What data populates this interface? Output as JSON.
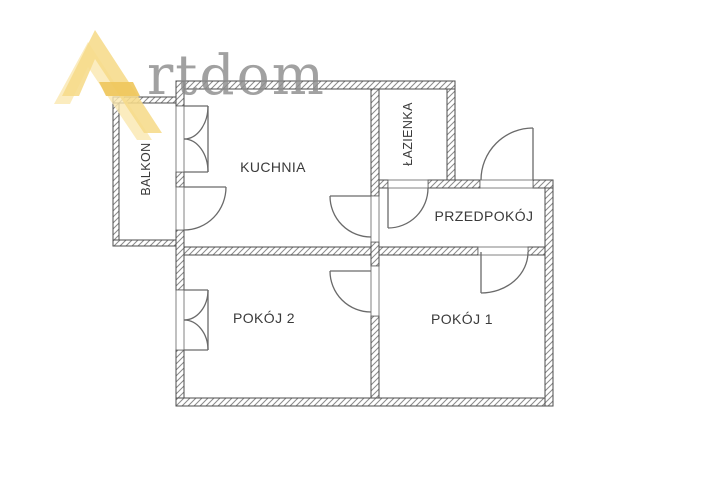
{
  "watermark": {
    "brand": "Artdom",
    "text": "rtdom",
    "logo_icon": "artdom-a-triangle-logo",
    "text_color": "#8d8d8d",
    "logo_color_light": "#fae7af",
    "logo_color_main": "#f6db8a",
    "logo_color_dark": "#eec75c"
  },
  "floor_plan": {
    "rooms": {
      "balkon": {
        "label": "BALKON"
      },
      "kuchnia": {
        "label": "KUCHNIA"
      },
      "lazienka": {
        "label": "ŁAZIENKA"
      },
      "przedpokoj": {
        "label": "PRZEDPOKÓJ"
      },
      "pokoj2": {
        "label": "POKÓJ 2"
      },
      "pokoj1": {
        "label": "POKÓJ 1"
      }
    },
    "openings": [
      "entrance-door",
      "bathroom-door",
      "kitchen-hall-door",
      "room1-hall-door",
      "room1-room2-door",
      "balcony-french-door",
      "balcony-single-door",
      "room2-window"
    ],
    "wall_outline_color": "#4d4d4d",
    "wall_hatch_color": "#8a8a8a",
    "door_line_color": "#6a6a6a",
    "label_color": "#3a3a3a"
  }
}
